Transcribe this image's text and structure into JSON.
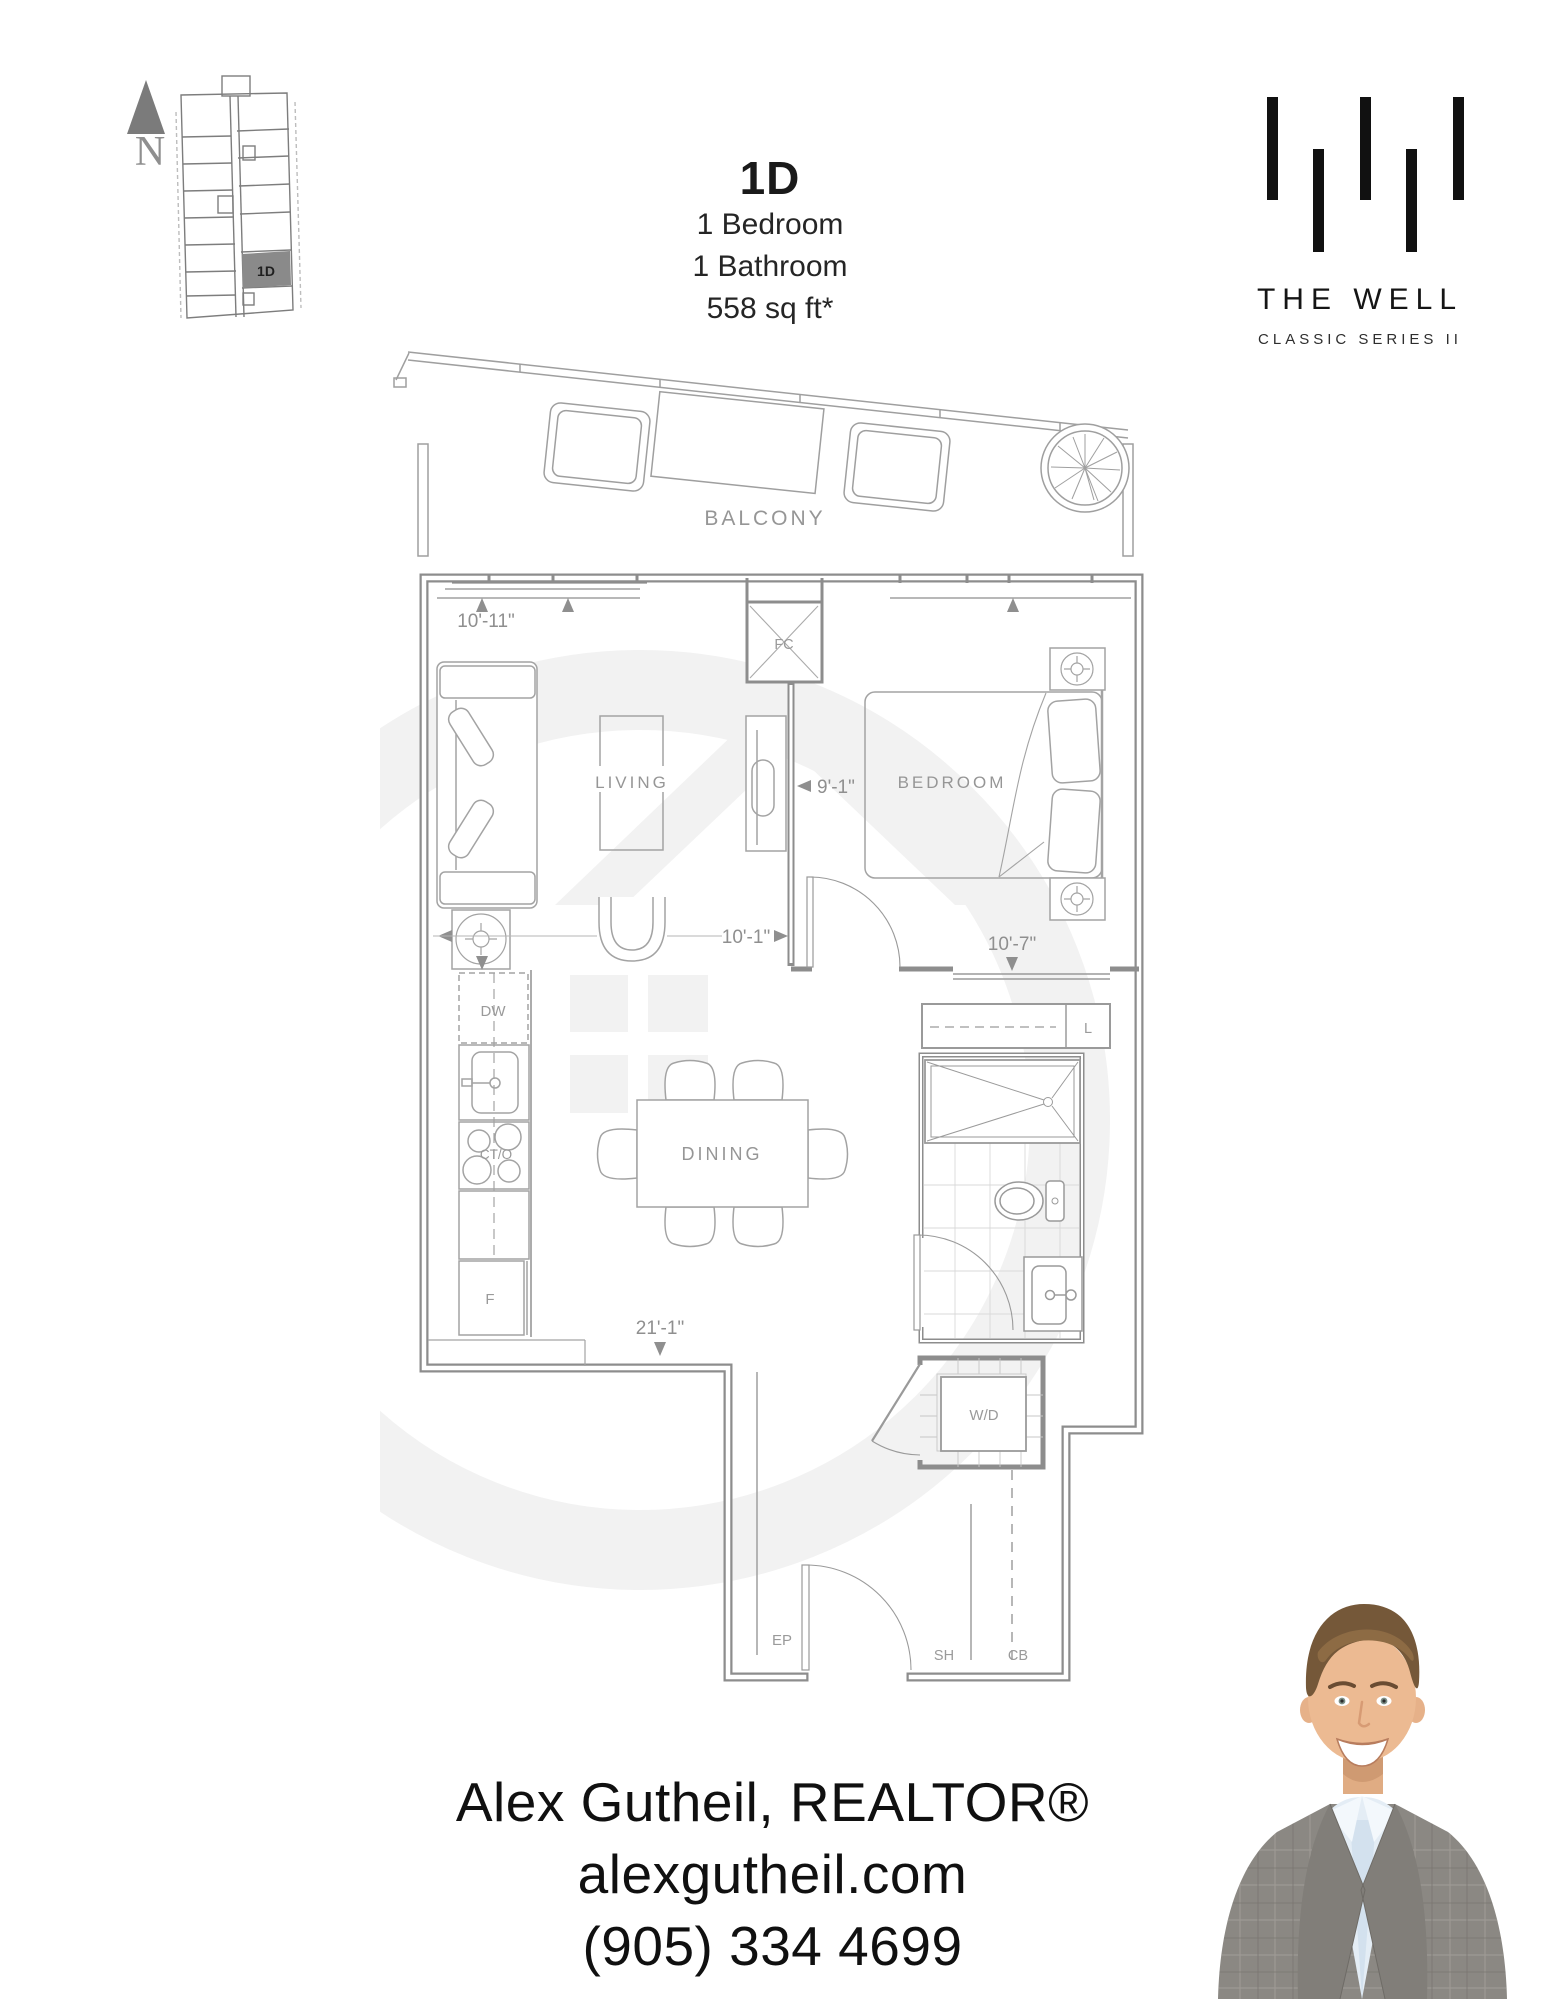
{
  "theme": {
    "accent_dark": "#1a1a1a",
    "plan_line": "#8d8d8d",
    "label_gray": "#969696",
    "watermark": "#f2f2f2",
    "keyplan_fill": "#8a8a8a"
  },
  "header": {
    "unit_code": "1D",
    "bedrooms": "1 Bedroom",
    "bathrooms": "1 Bathroom",
    "area": "558 sq ft*"
  },
  "brand": {
    "name": "THE WELL",
    "series": "CLASSIC SERIES II"
  },
  "keyplan": {
    "north_label": "N",
    "highlight_unit": "1D"
  },
  "plan": {
    "rooms": {
      "balcony": "BALCONY",
      "living": "LIVING",
      "bedroom": "BEDROOM",
      "dining": "DINING"
    },
    "fixtures": {
      "fc": "FC",
      "dw": "DW",
      "cto": "CT/O",
      "fridge": "F",
      "linen": "L",
      "washer_dryer": "W/D",
      "ep": "EP",
      "sh": "SH",
      "cb": "CB"
    },
    "dims": {
      "living_width": "10'-11\"",
      "bedroom_depth": "9'-1\"",
      "living_length": "10'-1\"",
      "bedroom_width": "10'-7\"",
      "overall_length": "21'-1\""
    }
  },
  "footer": {
    "agent": "Alex Gutheil, REALTOR®",
    "website": "alexgutheil.com",
    "phone": "(905) 334 4699"
  }
}
